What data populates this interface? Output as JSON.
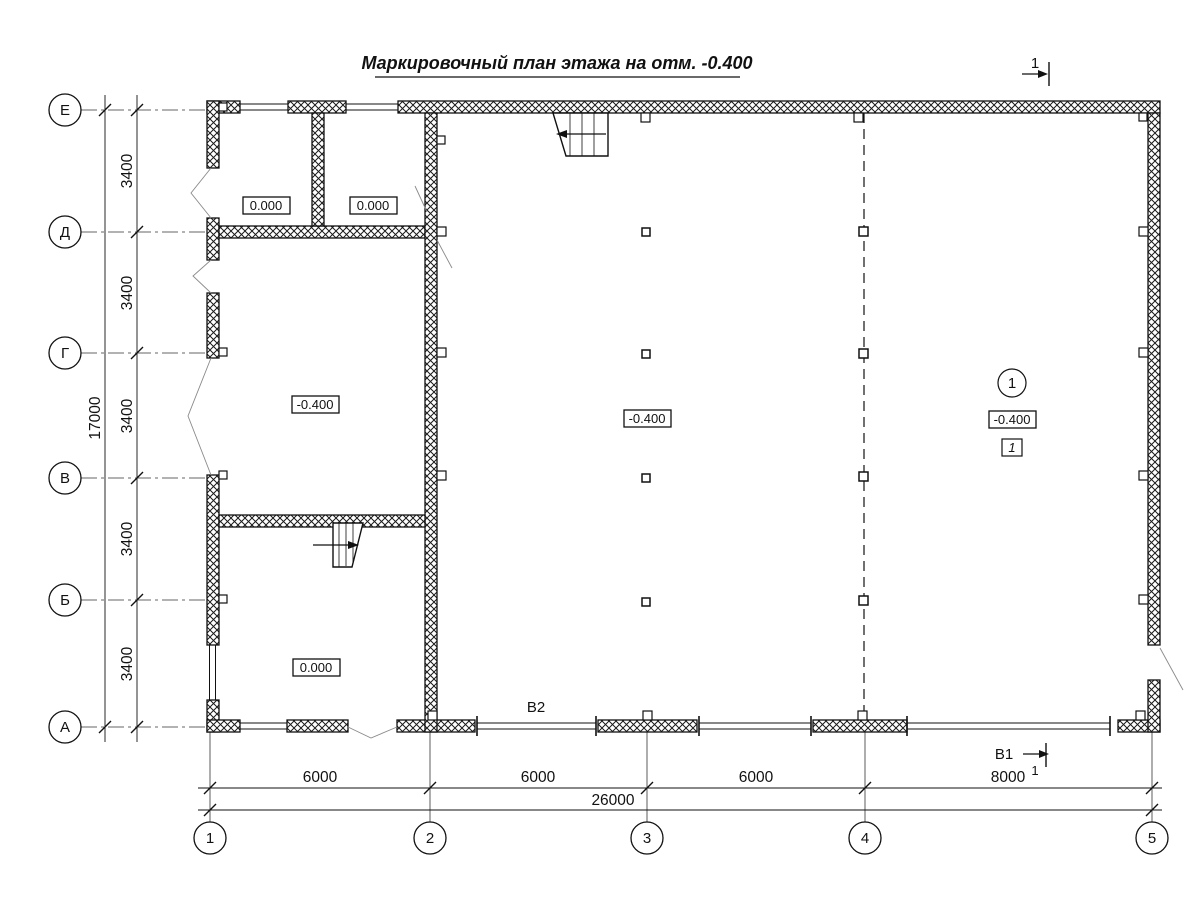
{
  "title": "Маркировочный план этажа на отм. -0.400",
  "axes": {
    "rows": [
      "Е",
      "Д",
      "Г",
      "В",
      "Б",
      "А"
    ],
    "cols": [
      "1",
      "2",
      "3",
      "4",
      "5"
    ]
  },
  "dimensions": {
    "row_segments": [
      "3400",
      "3400",
      "3400",
      "3400",
      "3400"
    ],
    "row_total": "17000",
    "col_segments": [
      "6000",
      "6000",
      "6000",
      "8000"
    ],
    "col_total": "26000"
  },
  "elevations": {
    "top_left_room": "0.000",
    "top_right_room": "0.000",
    "mid_left_room": "-0.400",
    "hall_center": "-0.400",
    "hall_right": "-0.400",
    "bottom_left_room": "0.000"
  },
  "marks": {
    "section_top_num": "1",
    "b1_label": "В1",
    "section_bottom_num": "1",
    "b2_label": "В2",
    "position_circle": "1",
    "position_item": "1"
  },
  "colors": {
    "line": "#111111",
    "aux": "#333333",
    "leaf": "#8a8a8a",
    "background": "#ffffff"
  }
}
